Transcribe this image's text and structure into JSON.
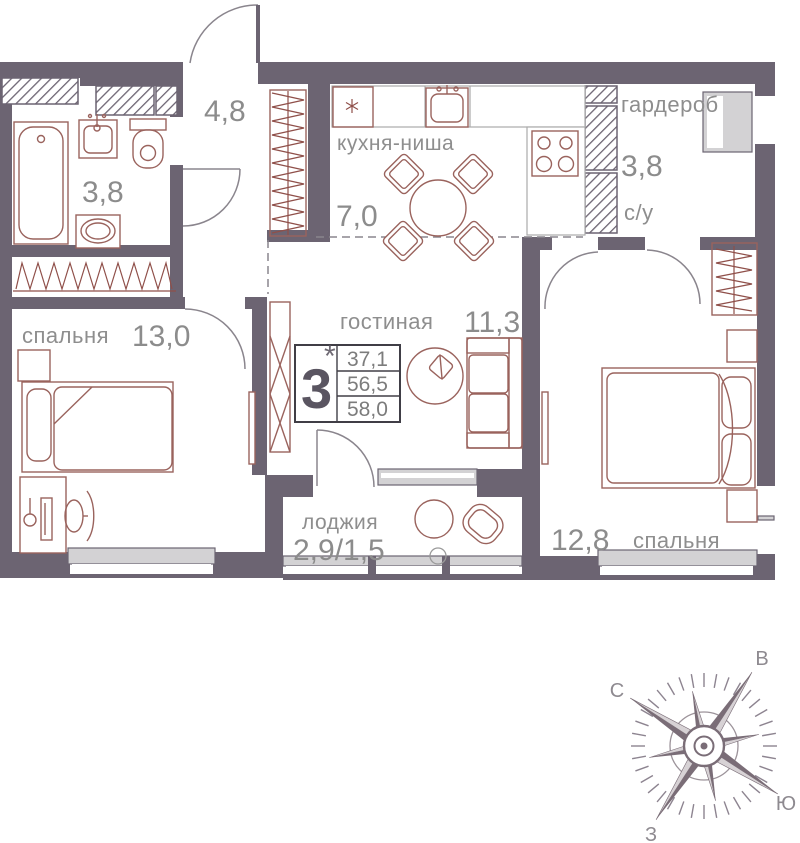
{
  "rooms": {
    "hallway": {
      "area": "4,8"
    },
    "bathroom": {
      "area": "3,8"
    },
    "kitchen": {
      "name": "кухня-ниша",
      "area": "7,0"
    },
    "wardrobe": {
      "name": "гардероб",
      "area": "3,8",
      "sublabel": "с/у"
    },
    "bedroom1": {
      "name": "спальня",
      "area": "13,0"
    },
    "living": {
      "name": "гостиная",
      "area": "11,3"
    },
    "loggia": {
      "name": "лоджия",
      "area": "2,9/1,5"
    },
    "bedroom2": {
      "name": "спальня",
      "area": "12,8"
    }
  },
  "stamp": {
    "rooms_count": "3",
    "note_mark": "*",
    "area_living": "37,1",
    "area_apartment": "56,5",
    "area_total": "58,0"
  },
  "compass": {
    "north": "С",
    "east": "В",
    "south": "Ю",
    "west": "З"
  },
  "colors": {
    "wall": "#6C6472",
    "furniture": "#9A635D",
    "zigzag": "#8F4F49",
    "label_text": "#8E8E8E",
    "window_fill": "#D3D2D4",
    "compass_dark": "#7A6D77",
    "compass_light": "#D7D2D5"
  }
}
